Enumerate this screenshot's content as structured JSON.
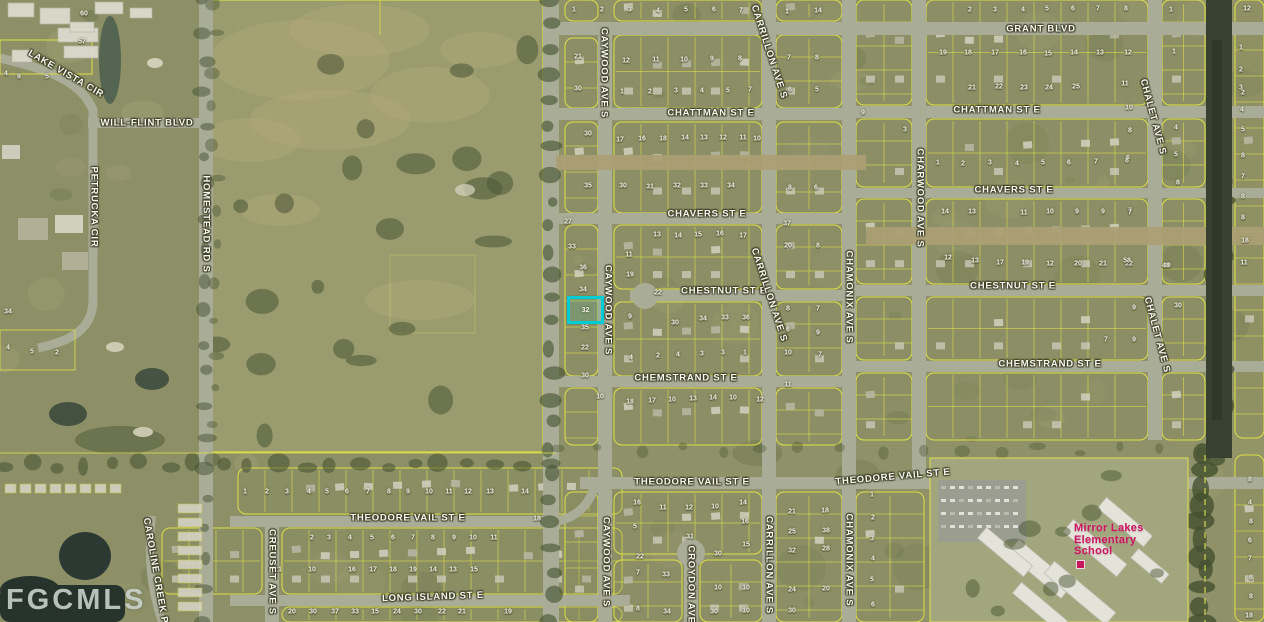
{
  "watermark": "FGCMLS",
  "school_label": {
    "lines": [
      "Mirror Lakes",
      "Elementary",
      "School"
    ],
    "color": "#c7175f",
    "x": 1074,
    "y": 523
  },
  "subject_parcel": {
    "number": "32",
    "highlight_color": "#00ccd4",
    "x": 567,
    "y": 296,
    "w": 31,
    "h": 22
  },
  "street_labels": [
    {
      "text": "GRANT BLVD",
      "x": 1041,
      "y": 29,
      "rot": 0
    },
    {
      "text": "CHATTMAN ST E",
      "x": 711,
      "y": 113,
      "rot": 0
    },
    {
      "text": "CHATTMAN ST E",
      "x": 997,
      "y": 110,
      "rot": 0
    },
    {
      "text": "CHAVERS ST E",
      "x": 707,
      "y": 214,
      "rot": 0
    },
    {
      "text": "CHAVERS ST E",
      "x": 1014,
      "y": 190,
      "rot": 0
    },
    {
      "text": "CHESTNUT ST E",
      "x": 724,
      "y": 291,
      "rot": 0
    },
    {
      "text": "CHESTNUT ST E",
      "x": 1013,
      "y": 286,
      "rot": 0
    },
    {
      "text": "CHEMSTRAND ST E",
      "x": 686,
      "y": 378,
      "rot": 0
    },
    {
      "text": "CHEMSTRAND ST E",
      "x": 1050,
      "y": 364,
      "rot": 0
    },
    {
      "text": "THEODORE VAIL ST E",
      "x": 408,
      "y": 518,
      "rot": 0
    },
    {
      "text": "THEODORE VAIL ST E",
      "x": 692,
      "y": 482,
      "rot": 0
    },
    {
      "text": "THEODORE VAIL ST E",
      "x": 893,
      "y": 477,
      "rot": -5
    },
    {
      "text": "LONG ISLAND ST E",
      "x": 433,
      "y": 597,
      "rot": -2
    },
    {
      "text": "WILL-FLINT BLVD",
      "x": 147,
      "y": 123,
      "rot": 0
    },
    {
      "text": "LAKE VISTA CIR",
      "x": 66,
      "y": 74,
      "rot": 30
    },
    {
      "text": "HOMESTEAD RD S",
      "x": 206,
      "y": 224,
      "rot": 90
    },
    {
      "text": "PETRUCKA CIR",
      "x": 94,
      "y": 207,
      "rot": 90
    },
    {
      "text": "CAYWOOD AVE S",
      "x": 604,
      "y": 73,
      "rot": 90
    },
    {
      "text": "CAYWOOD AVE S",
      "x": 608,
      "y": 310,
      "rot": 90
    },
    {
      "text": "CAYWOOD AVE S",
      "x": 606,
      "y": 562,
      "rot": 90
    },
    {
      "text": "CARRILLON AVE S",
      "x": 769,
      "y": 52,
      "rot": 72
    },
    {
      "text": "CARRILLON AVE S",
      "x": 769,
      "y": 295,
      "rot": 72
    },
    {
      "text": "CARRILLON AVE S",
      "x": 769,
      "y": 565,
      "rot": 90
    },
    {
      "text": "CHAMONIX AVE S",
      "x": 849,
      "y": 297,
      "rot": 90
    },
    {
      "text": "CHAMONIX AVE S",
      "x": 849,
      "y": 560,
      "rot": 90
    },
    {
      "text": "CHARWOOD AVE S",
      "x": 920,
      "y": 198,
      "rot": 90
    },
    {
      "text": "CHALET AVE S",
      "x": 1153,
      "y": 117,
      "rot": 75
    },
    {
      "text": "CHALET AVE S",
      "x": 1157,
      "y": 335,
      "rot": 75
    },
    {
      "text": "CREUSET AVE S",
      "x": 272,
      "y": 572,
      "rot": 90
    },
    {
      "text": "CAROLINE CREEK PL",
      "x": 156,
      "y": 574,
      "rot": 80
    },
    {
      "text": "CROYDON AVE S",
      "x": 691,
      "y": 590,
      "rot": 90
    }
  ],
  "parcel_numbers": [
    [
      2,
      970,
      10
    ],
    [
      3,
      995,
      10
    ],
    [
      4,
      1023,
      10
    ],
    [
      5,
      1047,
      9
    ],
    [
      6,
      1073,
      9
    ],
    [
      7,
      1098,
      9
    ],
    [
      8,
      1126,
      9
    ],
    [
      1,
      1171,
      10
    ],
    [
      12,
      1247,
      9
    ],
    [
      1,
      574,
      10
    ],
    [
      2,
      602,
      10
    ],
    [
      3,
      630,
      10
    ],
    [
      4,
      658,
      11
    ],
    [
      5,
      686,
      10
    ],
    [
      6,
      714,
      10
    ],
    [
      7,
      741,
      11
    ],
    [
      1,
      787,
      12
    ],
    [
      14,
      818,
      11
    ],
    [
      19,
      943,
      53
    ],
    [
      18,
      968,
      53
    ],
    [
      17,
      995,
      53
    ],
    [
      16,
      1023,
      53
    ],
    [
      15,
      1048,
      54
    ],
    [
      14,
      1074,
      53
    ],
    [
      13,
      1100,
      53
    ],
    [
      12,
      1128,
      53
    ],
    [
      1,
      1174,
      52
    ],
    [
      21,
      578,
      57
    ],
    [
      12,
      626,
      61
    ],
    [
      11,
      656,
      60
    ],
    [
      10,
      684,
      60
    ],
    [
      9,
      712,
      59
    ],
    [
      8,
      740,
      59
    ],
    [
      7,
      789,
      58
    ],
    [
      8,
      817,
      58
    ],
    [
      1,
      1241,
      48
    ],
    [
      2,
      1241,
      70
    ],
    [
      3,
      1241,
      88
    ],
    [
      4,
      1242,
      110
    ],
    [
      30,
      578,
      89
    ],
    [
      1,
      622,
      92
    ],
    [
      2,
      650,
      92
    ],
    [
      3,
      676,
      91
    ],
    [
      4,
      702,
      91
    ],
    [
      5,
      728,
      91
    ],
    [
      7,
      750,
      90
    ],
    [
      6,
      790,
      90
    ],
    [
      5,
      817,
      90
    ],
    [
      21,
      972,
      88
    ],
    [
      22,
      999,
      87
    ],
    [
      23,
      1024,
      88
    ],
    [
      24,
      1049,
      88
    ],
    [
      25,
      1076,
      87
    ],
    [
      11,
      1125,
      84
    ],
    [
      10,
      1129,
      108
    ],
    [
      30,
      588,
      134
    ],
    [
      17,
      620,
      140
    ],
    [
      16,
      642,
      139
    ],
    [
      18,
      663,
      139
    ],
    [
      14,
      685,
      138
    ],
    [
      13,
      704,
      138
    ],
    [
      12,
      723,
      138
    ],
    [
      11,
      743,
      138
    ],
    [
      10,
      757,
      139
    ],
    [
      3,
      905,
      130
    ],
    [
      9,
      863,
      113
    ],
    [
      2,
      1243,
      93
    ],
    [
      5,
      1243,
      130
    ],
    [
      8,
      1243,
      156
    ],
    [
      7,
      1243,
      177
    ],
    [
      8,
      1243,
      197
    ],
    [
      8,
      1243,
      218
    ],
    [
      18,
      1245,
      241
    ],
    [
      11,
      1244,
      263
    ],
    [
      8,
      1130,
      131
    ],
    [
      6,
      1128,
      158
    ],
    [
      4,
      1176,
      128
    ],
    [
      5,
      1176,
      155
    ],
    [
      8,
      1178,
      183
    ],
    [
      7,
      1130,
      211
    ],
    [
      1,
      938,
      163
    ],
    [
      2,
      963,
      164
    ],
    [
      3,
      990,
      163
    ],
    [
      4,
      1017,
      164
    ],
    [
      5,
      1043,
      163
    ],
    [
      6,
      1069,
      163
    ],
    [
      7,
      1096,
      162
    ],
    [
      8,
      1127,
      161
    ],
    [
      35,
      588,
      186
    ],
    [
      30,
      623,
      186
    ],
    [
      31,
      650,
      187
    ],
    [
      32,
      677,
      186
    ],
    [
      33,
      704,
      186
    ],
    [
      34,
      731,
      186
    ],
    [
      8,
      790,
      188
    ],
    [
      6,
      816,
      188
    ],
    [
      27,
      568,
      222
    ],
    [
      37,
      787,
      224
    ],
    [
      14,
      945,
      212
    ],
    [
      13,
      972,
      212
    ],
    [
      11,
      1024,
      213
    ],
    [
      10,
      1050,
      212
    ],
    [
      9,
      1077,
      212
    ],
    [
      9,
      1103,
      212
    ],
    [
      7,
      1130,
      213
    ],
    [
      13,
      657,
      235
    ],
    [
      14,
      678,
      236
    ],
    [
      15,
      698,
      235
    ],
    [
      16,
      720,
      234
    ],
    [
      17,
      743,
      236
    ],
    [
      20,
      788,
      246
    ],
    [
      8,
      818,
      246
    ],
    [
      33,
      572,
      247
    ],
    [
      11,
      629,
      255
    ],
    [
      36,
      583,
      268
    ],
    [
      19,
      630,
      275
    ],
    [
      12,
      948,
      258
    ],
    [
      13,
      975,
      261
    ],
    [
      17,
      1000,
      263
    ],
    [
      19,
      1025,
      263
    ],
    [
      12,
      1050,
      264
    ],
    [
      20,
      1078,
      264
    ],
    [
      21,
      1103,
      264
    ],
    [
      22,
      1129,
      264
    ],
    [
      20,
      1167,
      266
    ],
    [
      34,
      583,
      290
    ],
    [
      22,
      658,
      293
    ],
    [
      8,
      788,
      309
    ],
    [
      7,
      818,
      309
    ],
    [
      9,
      630,
      317
    ],
    [
      30,
      675,
      323
    ],
    [
      34,
      703,
      319
    ],
    [
      33,
      725,
      318
    ],
    [
      36,
      746,
      318
    ],
    [
      35,
      585,
      328
    ],
    [
      6,
      788,
      330
    ],
    [
      9,
      818,
      333
    ],
    [
      58,
      1127,
      261
    ],
    [
      48,
      1166,
      266
    ],
    [
      9,
      1134,
      308
    ],
    [
      30,
      1178,
      306
    ],
    [
      7,
      1106,
      340
    ],
    [
      9,
      1134,
      340
    ],
    [
      22,
      585,
      348
    ],
    [
      4,
      631,
      358
    ],
    [
      2,
      658,
      356
    ],
    [
      4,
      678,
      355
    ],
    [
      3,
      702,
      354
    ],
    [
      3,
      723,
      353
    ],
    [
      1,
      745,
      353
    ],
    [
      10,
      788,
      353
    ],
    [
      7,
      820,
      355
    ],
    [
      30,
      585,
      376
    ],
    [
      11,
      788,
      385
    ],
    [
      10,
      600,
      397
    ],
    [
      18,
      630,
      402
    ],
    [
      17,
      652,
      401
    ],
    [
      10,
      672,
      400
    ],
    [
      13,
      693,
      399
    ],
    [
      14,
      713,
      398
    ],
    [
      10,
      733,
      398
    ],
    [
      12,
      760,
      400
    ],
    [
      60,
      84,
      14
    ],
    [
      57,
      82,
      42
    ],
    [
      4,
      6,
      74
    ],
    [
      9,
      19,
      77
    ],
    [
      5,
      47,
      77
    ],
    [
      34,
      8,
      312
    ],
    [
      4,
      8,
      348
    ],
    [
      5,
      32,
      352
    ],
    [
      2,
      57,
      353
    ],
    [
      1,
      245,
      492
    ],
    [
      2,
      267,
      492
    ],
    [
      3,
      287,
      492
    ],
    [
      4,
      309,
      492
    ],
    [
      5,
      327,
      492
    ],
    [
      6,
      347,
      492
    ],
    [
      7,
      368,
      492
    ],
    [
      8,
      389,
      492
    ],
    [
      9,
      408,
      492
    ],
    [
      10,
      429,
      492
    ],
    [
      11,
      449,
      492
    ],
    [
      12,
      468,
      492
    ],
    [
      13,
      490,
      492
    ],
    [
      14,
      525,
      492
    ],
    [
      18,
      537,
      519
    ],
    [
      2,
      312,
      538
    ],
    [
      3,
      329,
      538
    ],
    [
      4,
      350,
      538
    ],
    [
      5,
      372,
      538
    ],
    [
      6,
      393,
      538
    ],
    [
      7,
      413,
      538
    ],
    [
      8,
      433,
      538
    ],
    [
      9,
      454,
      538
    ],
    [
      10,
      473,
      538
    ],
    [
      11,
      494,
      538
    ],
    [
      21,
      278,
      570
    ],
    [
      10,
      312,
      570
    ],
    [
      16,
      352,
      570
    ],
    [
      17,
      373,
      570
    ],
    [
      18,
      393,
      570
    ],
    [
      19,
      413,
      570
    ],
    [
      14,
      433,
      570
    ],
    [
      13,
      453,
      570
    ],
    [
      15,
      474,
      570
    ],
    [
      20,
      292,
      612
    ],
    [
      30,
      313,
      612
    ],
    [
      37,
      335,
      612
    ],
    [
      33,
      355,
      612
    ],
    [
      15,
      375,
      612
    ],
    [
      24,
      397,
      612
    ],
    [
      30,
      418,
      612
    ],
    [
      22,
      442,
      612
    ],
    [
      21,
      462,
      612
    ],
    [
      19,
      508,
      612
    ],
    [
      16,
      637,
      503
    ],
    [
      11,
      663,
      508
    ],
    [
      12,
      689,
      508
    ],
    [
      10,
      715,
      507
    ],
    [
      14,
      743,
      503
    ],
    [
      21,
      792,
      512
    ],
    [
      18,
      825,
      511
    ],
    [
      5,
      635,
      527
    ],
    [
      16,
      745,
      522
    ],
    [
      25,
      792,
      532
    ],
    [
      38,
      826,
      531
    ],
    [
      31,
      690,
      537
    ],
    [
      22,
      640,
      557
    ],
    [
      30,
      718,
      554
    ],
    [
      15,
      746,
      545
    ],
    [
      32,
      792,
      551
    ],
    [
      28,
      826,
      549
    ],
    [
      7,
      638,
      573
    ],
    [
      33,
      666,
      575
    ],
    [
      18,
      693,
      587
    ],
    [
      10,
      718,
      588
    ],
    [
      10,
      746,
      588
    ],
    [
      24,
      792,
      590
    ],
    [
      20,
      826,
      589
    ],
    [
      8,
      638,
      609
    ],
    [
      34,
      667,
      612
    ],
    [
      30,
      714,
      612
    ],
    [
      10,
      746,
      611
    ],
    [
      30,
      792,
      611
    ],
    [
      1,
      872,
      495
    ],
    [
      2,
      873,
      518
    ],
    [
      3,
      872,
      539
    ],
    [
      4,
      873,
      559
    ],
    [
      5,
      872,
      580
    ],
    [
      6,
      873,
      605
    ],
    [
      8,
      1250,
      480
    ],
    [
      4,
      1250,
      503
    ],
    [
      8,
      1251,
      522
    ],
    [
      6,
      1250,
      541
    ],
    [
      7,
      1250,
      559
    ],
    [
      6,
      1251,
      578
    ],
    [
      8,
      1251,
      597
    ],
    [
      18,
      1249,
      616
    ]
  ]
}
